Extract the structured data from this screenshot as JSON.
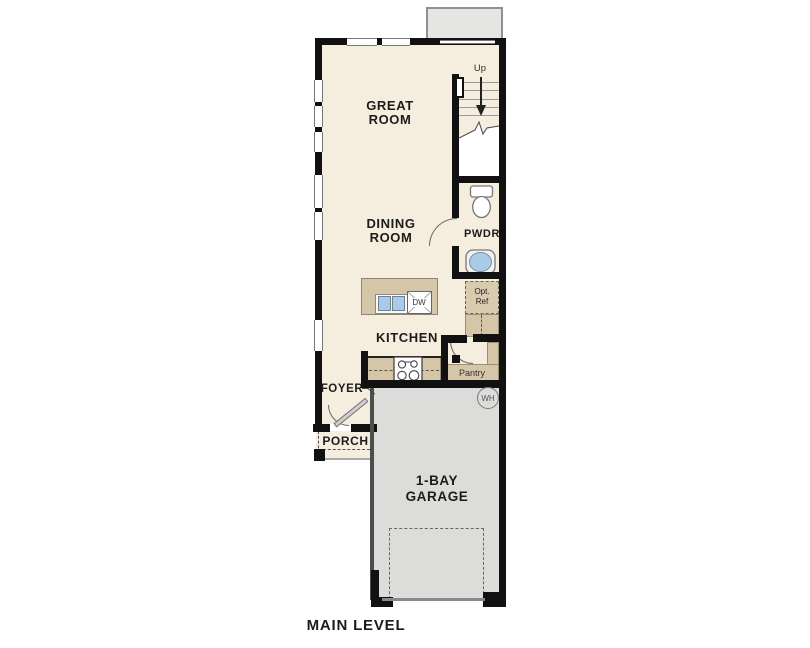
{
  "title": {
    "label": "MAIN LEVEL"
  },
  "rooms": {
    "great_room": {
      "line1": "GREAT",
      "line2": "ROOM"
    },
    "dining_room": {
      "line1": "DINING",
      "line2": "ROOM"
    },
    "kitchen": {
      "label": "KITCHEN"
    },
    "powder": {
      "label": "PWDR"
    },
    "pantry": {
      "label": "Pantry"
    },
    "foyer": {
      "label": "FOYER"
    },
    "porch": {
      "label": "PORCH"
    },
    "garage": {
      "line1": "1-BAY",
      "line2": "GARAGE"
    }
  },
  "annotations": {
    "stairs_direction": "Up",
    "dishwasher": "DW",
    "water_heater": "WH",
    "opt_ref_line1": "Opt.",
    "opt_ref_line2": "Ref"
  },
  "colors": {
    "wall": "#111111",
    "floor": "#f5eddd",
    "counter": "#d5c6a7",
    "garage_floor": "#dcdcda",
    "bay_gray": "#e5e5e3",
    "fixture_blue": "#a9cbe9"
  }
}
